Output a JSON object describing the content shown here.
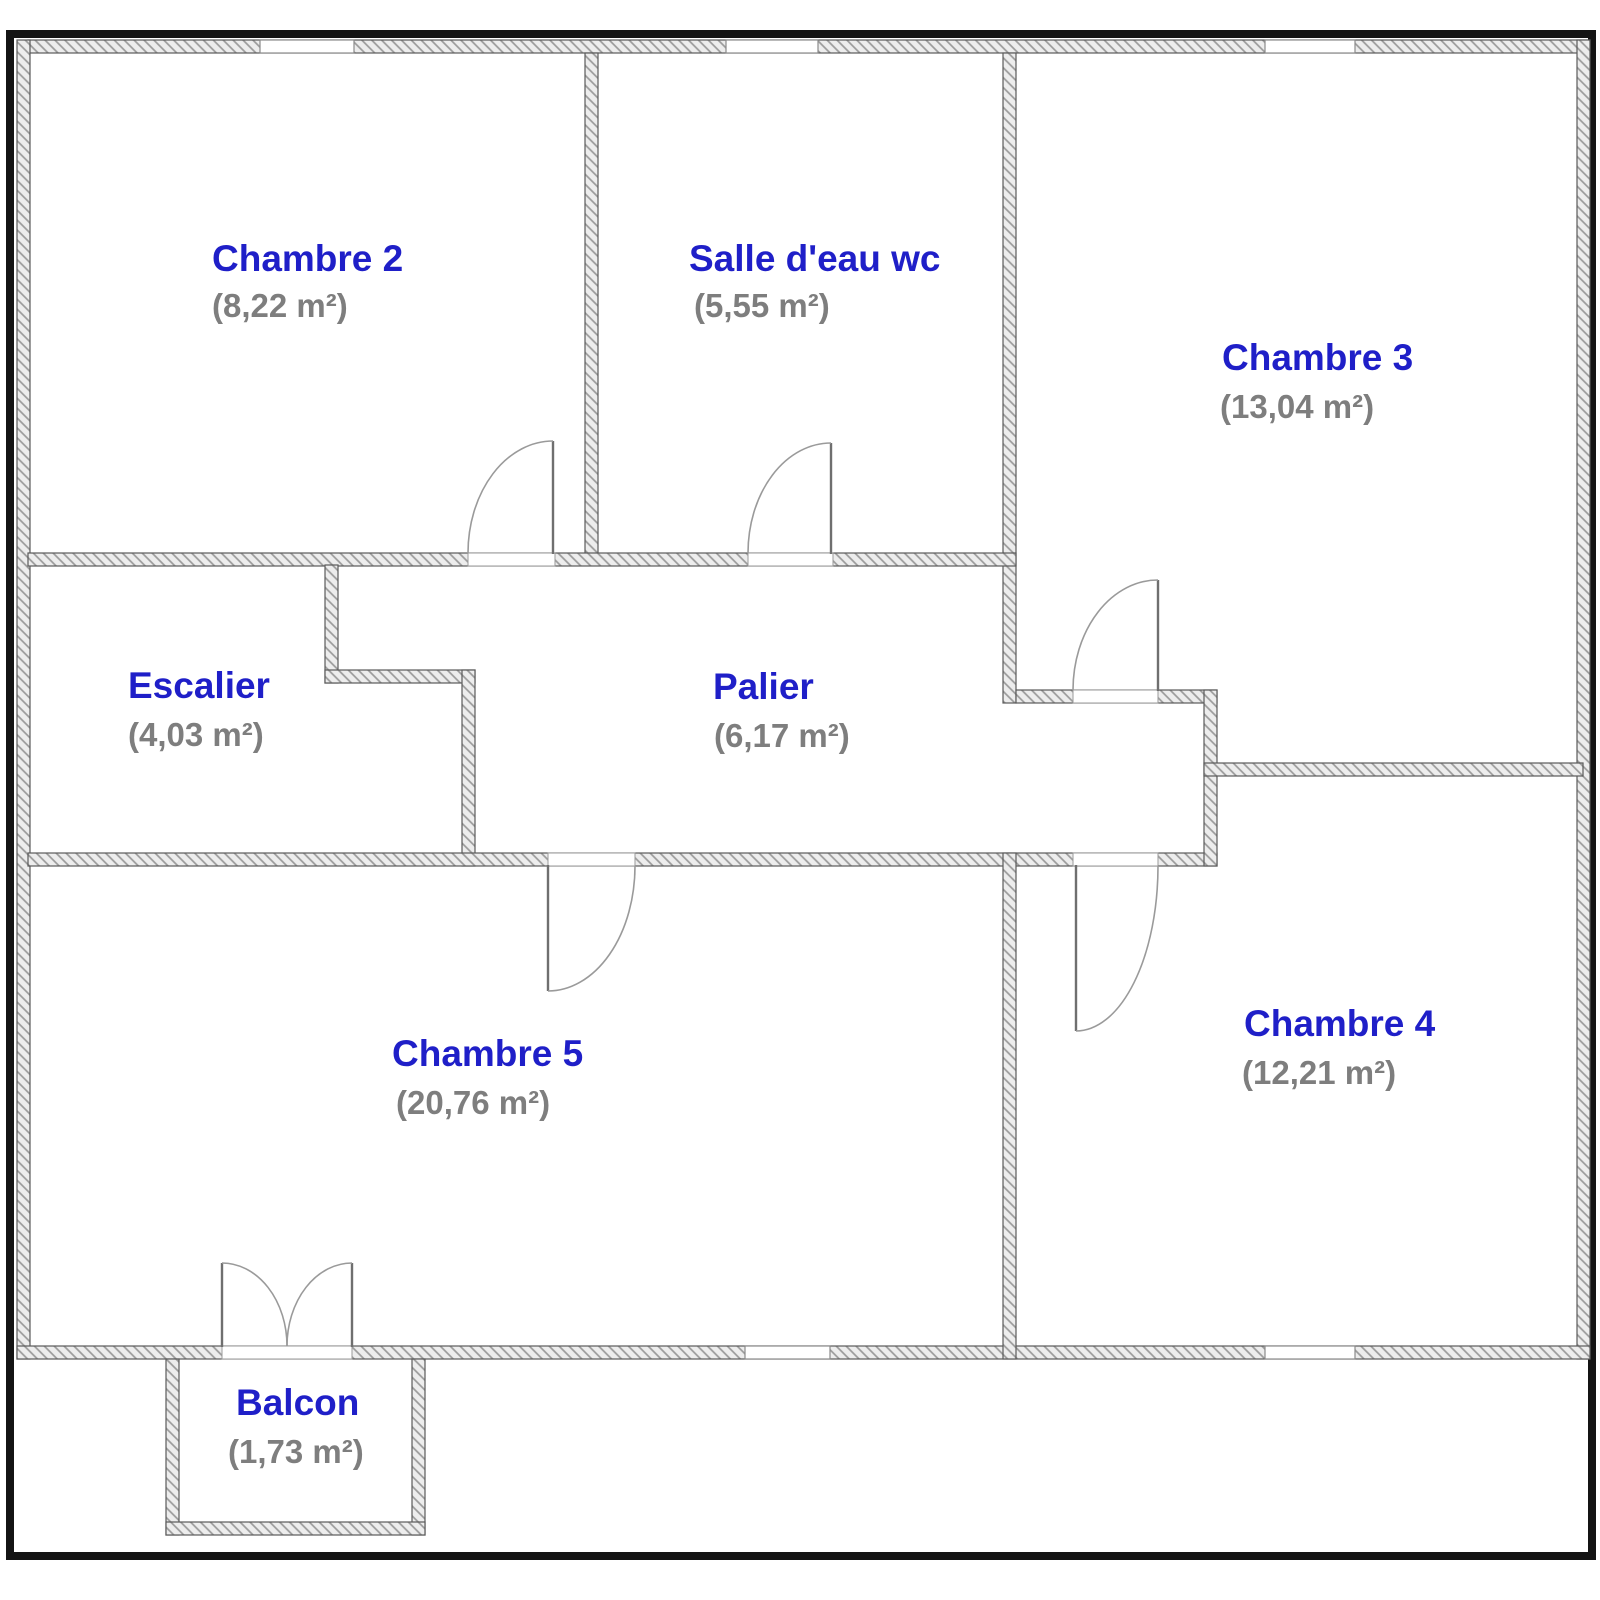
{
  "floor_plan": {
    "rooms": [
      {
        "id": "chambre2",
        "name": "Chambre 2",
        "area": "(8,22 m²)"
      },
      {
        "id": "salledeau",
        "name": "Salle d'eau wc",
        "area": "(5,55 m²)"
      },
      {
        "id": "chambre3",
        "name": "Chambre 3",
        "area": "(13,04 m²)"
      },
      {
        "id": "escalier",
        "name": "Escalier",
        "area": "(4,03 m²)"
      },
      {
        "id": "palier",
        "name": "Palier",
        "area": "(6,17 m²)"
      },
      {
        "id": "chambre5",
        "name": "Chambre 5",
        "area": "(20,76 m²)"
      },
      {
        "id": "chambre4",
        "name": "Chambre 4",
        "area": "(12,21 m²)"
      },
      {
        "id": "balcon",
        "name": "Balcon",
        "area": "(1,73 m²)"
      }
    ],
    "colors": {
      "room_name": "#1f1fc8",
      "room_area": "#7e7e7e",
      "wall_fill": "#ededed",
      "wall_hatch": "#9a9a9a",
      "wall_outline": "#5a5a5a",
      "frame": "#141414"
    }
  }
}
